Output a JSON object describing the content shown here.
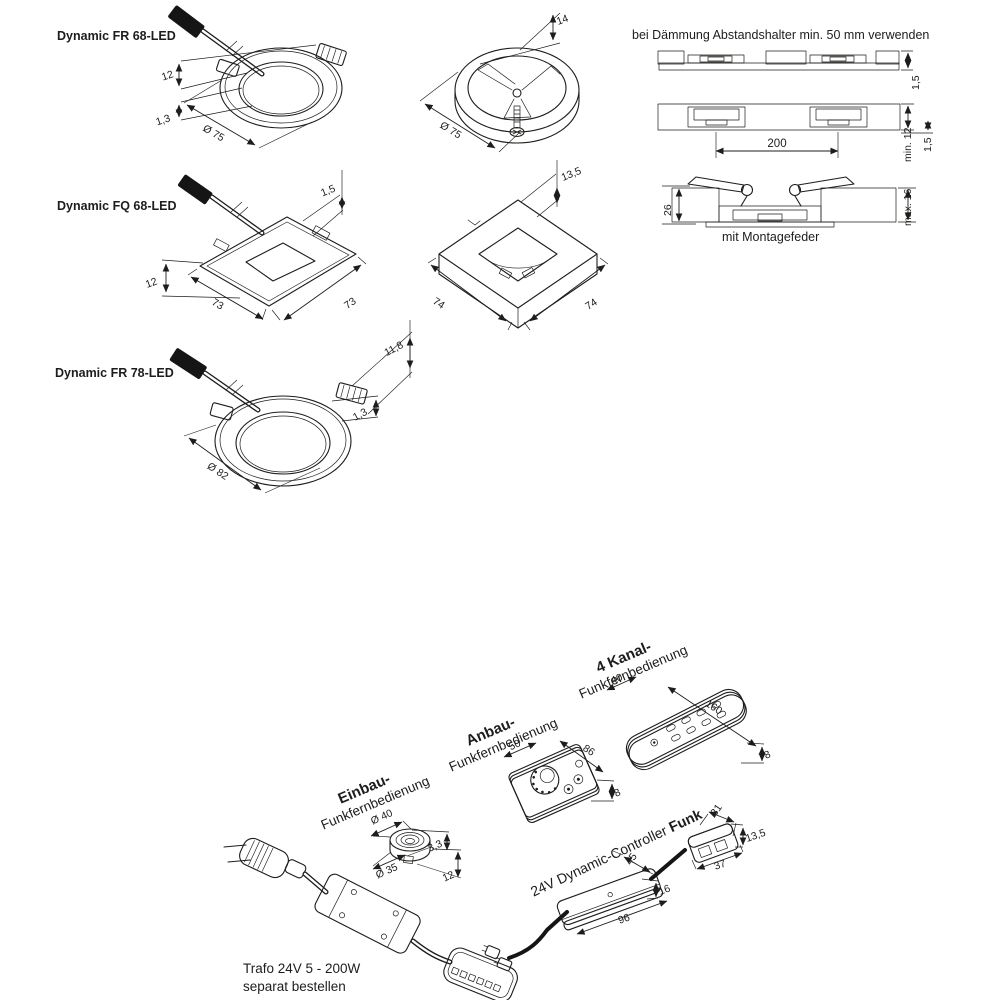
{
  "titles": {
    "fr68": "Dynamic FR 68-LED",
    "fq68": "Dynamic FQ 68-LED",
    "fr78": "Dynamic FR 78-LED"
  },
  "note_daemmung": "bei Dämmung Abstandshalter min. 50 mm verwenden",
  "caption_montagefeder": "mit Montagefeder",
  "dims": {
    "fr68": {
      "height": "12",
      "rim": "1,3",
      "diameter": "Ø 75"
    },
    "ring": {
      "height": "14",
      "diameter": "Ø 75"
    },
    "fq68": {
      "rim": "1,5",
      "height": "12",
      "width": "73",
      "depth": "73"
    },
    "frame": {
      "height": "13,5",
      "width": "74",
      "depth": "74"
    },
    "fr78": {
      "height": "11,8",
      "rim": "1,3",
      "diameter": "Ø 82"
    },
    "cross": {
      "panel_top": "1,5",
      "spacing": "200",
      "min_depth": "min. 12",
      "panel_bottom": "1,5",
      "spring": "26",
      "max_depth": "max. 16"
    },
    "einbau": {
      "outer": "Ø 40",
      "inner": "Ø 35",
      "lip": "3,3",
      "depth": "12"
    },
    "anbau": {
      "width": "50",
      "length": "86",
      "height": "8"
    },
    "kanal4": {
      "width": "40",
      "length": "160",
      "height": "8"
    },
    "controller": {
      "width": "45",
      "length": "96",
      "height": "16"
    },
    "receiver": {
      "width": "31",
      "length": "37",
      "height": "13,5"
    }
  },
  "labels": {
    "einbau_bold": "Einbau-",
    "einbau_rest": "Funkfernbedienung",
    "anbau_bold": "Anbau-",
    "anbau_rest": "Funkfernbedienung",
    "kanal4_bold": "4 Kanal-",
    "kanal4_rest": "Funkfernbedienung",
    "controller_plain": "24V Dynamic-Controller ",
    "controller_bold": "Funk",
    "trafo_line1": "Trafo 24V 5 - 200W",
    "trafo_line2": "separat bestellen"
  },
  "colors": {
    "ink": "#1d1d1b",
    "gray": "#c9c9c9",
    "light": "#ececec",
    "white": "#ffffff"
  }
}
